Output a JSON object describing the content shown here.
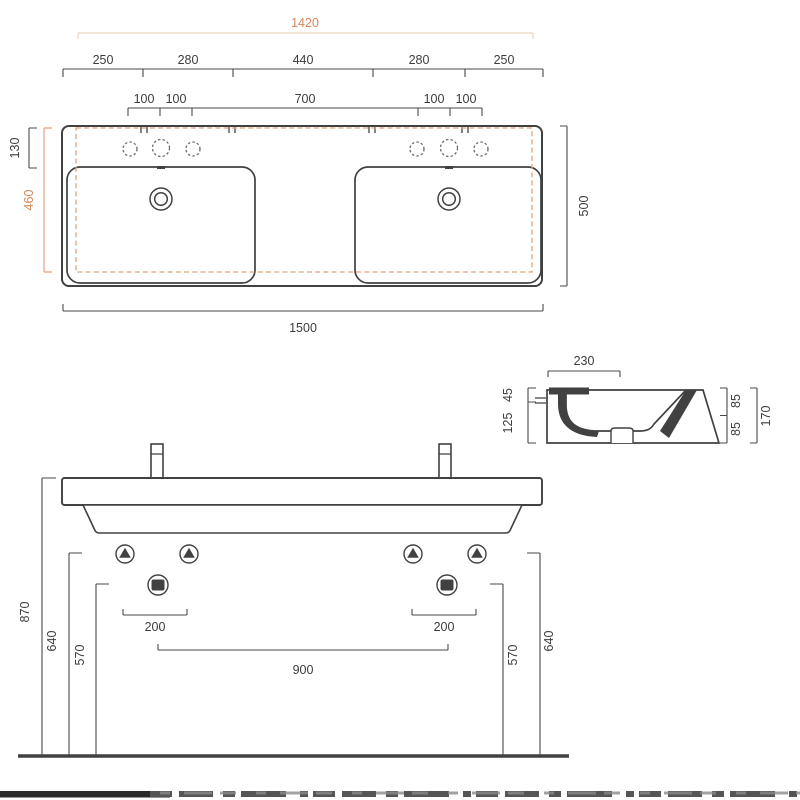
{
  "drawing_title": "double washbasin technical dimension drawing",
  "colors": {
    "ink": "#414141",
    "dim_line": "#4a4a4a",
    "accent": "#d4875a",
    "accent_dash": "#dfa57b",
    "accent_light_bracket": "#ecd3bd"
  },
  "top_view": {
    "width_1420": "1420",
    "segments": [
      "250",
      "280",
      "440",
      "280",
      "250"
    ],
    "tap_spacing": [
      "100",
      "100",
      "700",
      "100",
      "100"
    ],
    "deck_depth": "130",
    "basin_depth": "460",
    "overall_depth": "500",
    "overall_width": "1500"
  },
  "section_view": {
    "depth": "230",
    "rim_thickness": "45",
    "front_height": "125",
    "back_upper": "85",
    "back_lower": "85",
    "total_height": "170"
  },
  "front_view": {
    "rim_height": "870",
    "fixing_height_left": "640",
    "trap_height_left": "570",
    "drain_width_left": "200",
    "drain_width_right": "200",
    "drain_spacing": "900",
    "trap_height_right": "570",
    "fixing_height_right": "640"
  }
}
